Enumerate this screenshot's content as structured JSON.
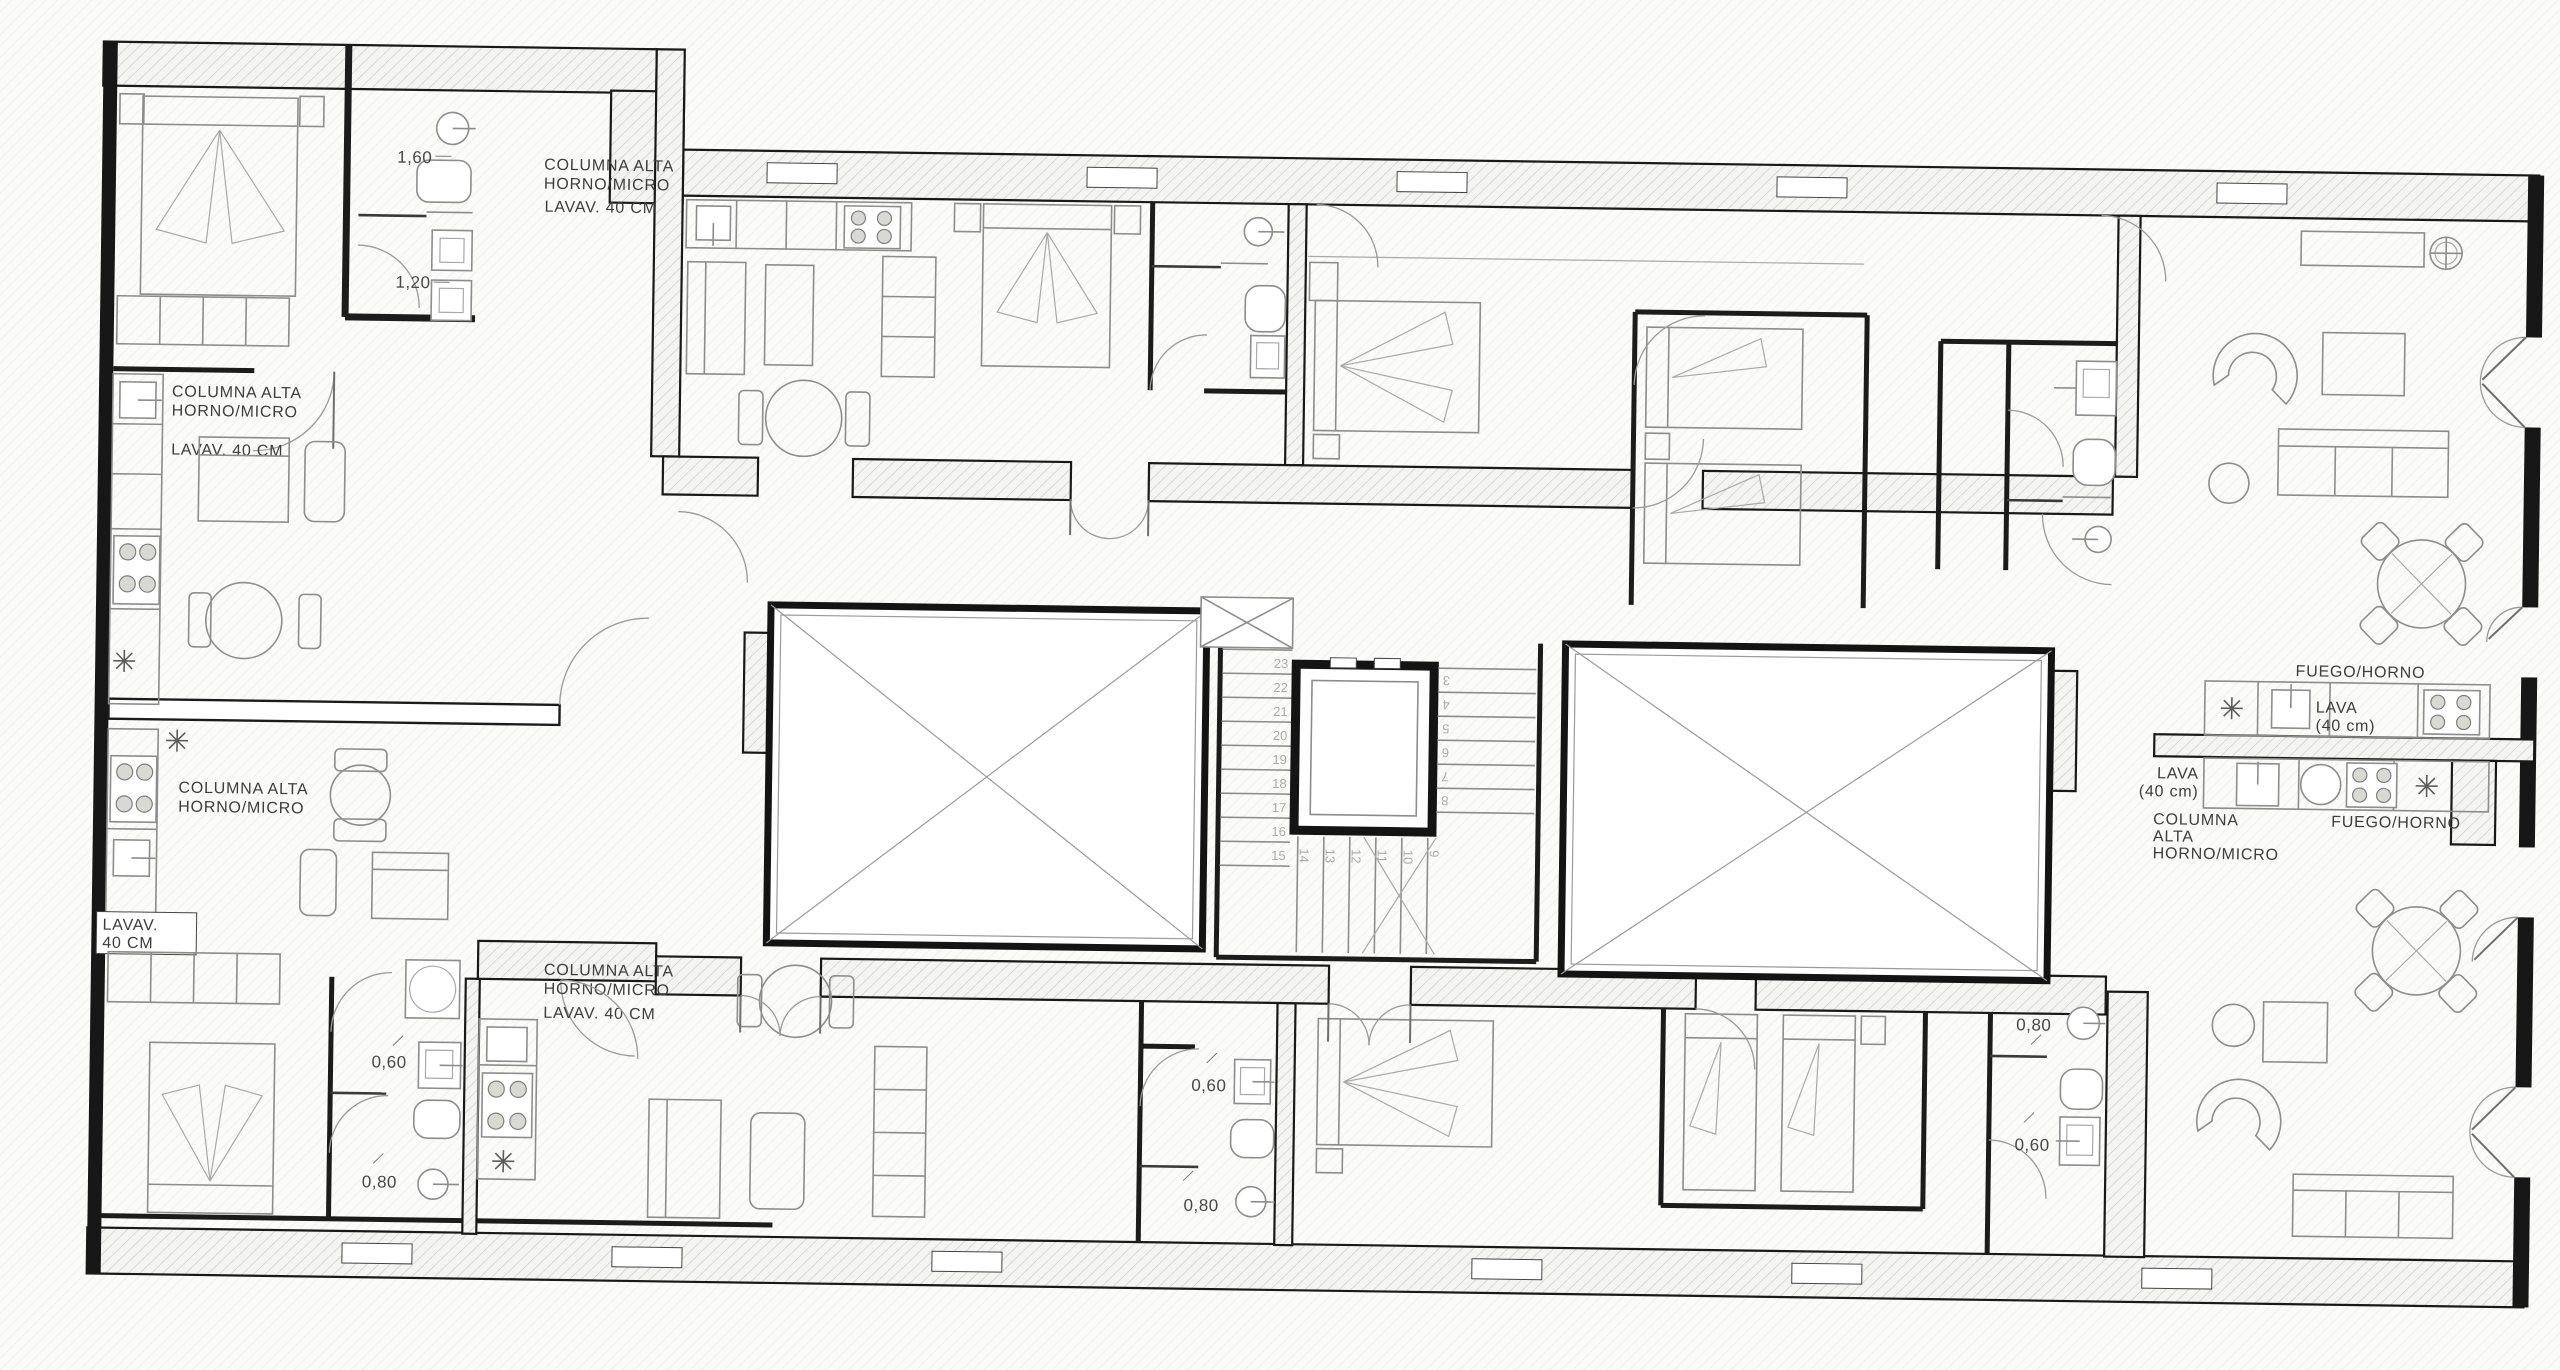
{
  "drawing": {
    "type": "architectural-floor-plan",
    "description": "Residential floor plan with eight apartment units around a central stair and elevator core flanked by two cross-braced light wells"
  },
  "labels": {
    "kitchen_a": {
      "line1": "COLUMNA ALTA",
      "line2": "HORNO/MICRO",
      "lav": "LAVAV. 40 CM"
    },
    "kitchen_b": {
      "line1": "COLUMNA ALTA",
      "line2": "HORNO/MICRO",
      "lav": "LAVAV. 40 CM"
    },
    "kitchen_e": {
      "line1": "COLUMNA ALTA",
      "line2": "HORNO/MICRO",
      "lav_line1": "LAVAV.",
      "lav_line2": "40 CM"
    },
    "kitchen_f": {
      "line1": "COLUMNA ALTA",
      "line2": "HORNO/MICRO",
      "lav": "LAVAV. 40 CM"
    },
    "kitchen_d": {
      "fuego": "FUEGO/HORNO",
      "lava_line1": "LAVA",
      "lava_line2": "(40 cm)"
    },
    "kitchen_h": {
      "fuego": "FUEGO/HORNO",
      "lava_line1": "LAVA",
      "lava_line2": "(40 cm)",
      "col_line1": "COLUMNA",
      "col_line2": "ALTA",
      "col_line3": "HORNO/MICRO"
    }
  },
  "dimensions": {
    "bath_a": {
      "top": "1,60",
      "bottom": "1,20"
    },
    "bath_e": {
      "top": "0,60",
      "bottom": "0,80"
    },
    "bath_f": {
      "top": "0,60",
      "bottom": "0,80"
    },
    "bath_g": {
      "top": "0,80",
      "bottom": "0,60"
    }
  },
  "stairs": {
    "left_flight": [
      "15",
      "16",
      "17",
      "18",
      "19",
      "20",
      "21",
      "22",
      "23"
    ],
    "bottom_flight": [
      "9",
      "10",
      "11",
      "12",
      "13",
      "14"
    ],
    "right_flight": [
      "3",
      "4",
      "5",
      "6",
      "7",
      "8"
    ]
  },
  "icons": {
    "vent_symbol": "eight-spoked-asterisk",
    "ceiling_light": "circle-with-cross"
  },
  "colors": {
    "wall": "#171717",
    "hatch_line": "#c9c9c4",
    "hatch_bg": "#f4f4f2",
    "furniture_line": "#8d8d8d",
    "label_text": "#3d3d3d",
    "dim_text": "#474747",
    "stair_number": "#ababab",
    "background": "#fbfbf9"
  }
}
